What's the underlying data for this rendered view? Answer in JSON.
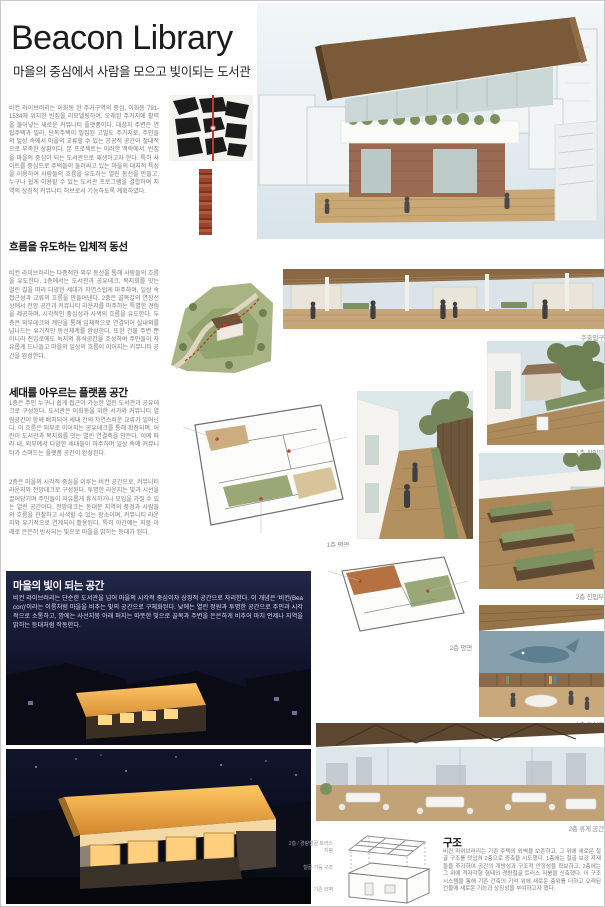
{
  "header": {
    "title": "Beacon Library",
    "subtitle": "마을의 중심에서 사람을 모으고 빛이되는 도서관"
  },
  "intro": {
    "text": "비컨 라이브러리는 이화동 한 주거구역의 중심, 이화동 791-1534에 위치한 빈집을 리모델링하여, 오래된 주거지에 활력을 불어넣는 새로운 커뮤니티 플랫폼이다. 대상지 주변은 연립주택과 빌라, 단독주택이 밀집된 고밀도 주거지로, 주민들의 일상 속에서 마을의 교류할 수 있는 공공적 공간이 절대적으로 부족한 상황이다. 본 프로젝트는 이러한 맥락에서, 빈집을 마을의 중심이 되는 도서관으로 재생하고자 한다. 특히 사이트를 중심으로 주택들이 둘러싸고 있는 마을의 대지적 특성을 이용하여 사람들의 흐름을 유도하는 열린 동선을 만들고, 누구나 쉽게 이용할 수 있는 도서관 프로그램을 결합하여 지역의 상징적 커뮤니티 허브로서 기능하도록 계획하였다."
  },
  "sections": [
    {
      "title": "흐름을 유도하는 입체적 동선",
      "body": "비컨 라이브러리는 다층적인 외부 동선을 통해 사람들의 흐름을 유도한다. 1층에서는 도서관과 공유데크, 복지회를 잇는 열린 길을 따라 다양한 세대가 자연스럽게 마주하며, 일상 속 접근성과 교류의 흐름을 만들어낸다. 2층은 골목길의 연장선상에서 전망 공간과 커뮤니티 라운지를 마주하는 특별한 경험을 제공하며, 시각적인 중심성과 사색의 흐름을 유도한다. 두 층은 외부데크와 계단을 통해 입체적으로 연결되어 실내외를 넘나드는 유기적인 동선체계를 완성한다. 또한 건물 주변 뿐 아니라 진입로에도 녹지와 휴식공간을 조성하여 주민들이 자유롭게 드나들고 마을의 일상의 흐름이 이어지는 커뮤니티 공간을 완성한다.",
      "caption_main_entrance": "주출입구"
    },
    {
      "title": "세대를 아우르는 플랫폼 공간",
      "body_floor1": "1층은 주민 누구나 쉽게 접근이 가능한 열린 도서관과 공유데크로 구성된다. 도서관은 이화동을 위한 서가와 커뮤니티 열람공간이 함께 배치되어 세대 간의 자연스러운 교류가 일어난다. 이 흐름은 외부로 이어지는 공유데크를 통해 확장되며, 어린이 도서관과 복지회를 잇는 열린 연결축을 만든다. 이에 따라 내, 외부에서 다양한 세대들이 마주하며 일상 속에 커뮤니티가 스며드는 플랫폼 공간이 완성된다.",
      "body_floor2": "2층은 마을의 시각적 중심을 이루는 비컨 공간으로, 커뮤니티 라운지와 전망데크로 구성된다. 투명한 라운지는 빛과 시선을 끌어당기며 주민들이 자유롭게 휴식하거나 모임을 가질 수 있는 열린 공간이다. 전망데크는 동대문 지역의 풍경과 사람들의 흐름을 관찰하고 사색할 수 있는 장소이며, 커뮤니티 라운지와 유기적으로 연계되어 활용된다. 특히 야간에는 지붕 아래로 은은히 반사되는 빛으로 마을을 밝히는 등대가 된다.",
      "caption_plan1": "1층 평면",
      "caption_plan2": "2층 평면",
      "caption_entry1": "1층 진입부",
      "caption_entry2": "2층 진입부"
    },
    {
      "title": "마을의 빛이 되는 공간",
      "body": "비컨 라이브러리는 단순한 도서관을 넘어 마을의 시각적 중심이자 상징적 공간으로 자리한다. 이 개념은 '비컨(Beacon)'이라는 이름처럼 마을을 비추는 빛의 공간으로 구체화된다. 낮에는 열린 정원과 투명한 공간으로 주민과 시각적으로 소통하고, 밤에는 사선지붕 아래 퍼지는 따뜻한 빛으로 골목과 주변을 은은하게 비추어 마치 언제나 지역을 밝히는 등대처럼 작동한다.",
      "caption_library": "1층 도서관",
      "caption_lounge": "2층 휴게 공간"
    },
    {
      "title": "구조",
      "body": "비컨 라이브러리는 기존 주택의 외벽을 보존하고, 그 위에 새로운 철골 구조를 덧입혀 2층으로 증축을 시도했다. 1층에는 철골 보강 자재들을 추가하여 공간의 개방성과 구조적 안정성을 확보하고, 2층에는 그 위에 격자각형 형태의 경량철골 트러스 지붕을 신축했다. 이 구조 시스템을 통해 기존 건축의 기억 위에 새로운 층위를 더하고 오래된 건물에 새로운 기능과 상징성을 부여하고자 했다.",
      "diagram_labels": [
        "2층 / 경량철골 트러스 지붕",
        "철골 기둥 구조",
        "기존 외벽"
      ]
    }
  ],
  "colors": {
    "accent_red": "#c0392b",
    "night_blue": "#0c0e1c",
    "wood": "#a98b5f",
    "green": "#7d9060"
  }
}
